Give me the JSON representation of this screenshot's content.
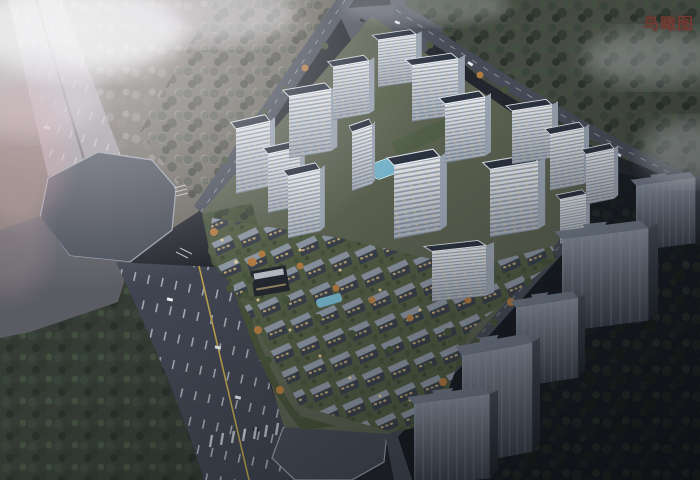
{
  "overlay": {
    "label": "鸟瞰图"
  },
  "scene": {
    "type": "architectural aerial rendering, dusk",
    "features": [
      "white high-rise residential towers along north and east edges (16 visible)",
      "central low-rise courtyard villa district with lit paths and small pools",
      "two octagonal road intersections (west, south)",
      "wide multi-lane boulevard with yellow centerline on the south-west",
      "five dark unlit massing tower blocks on dark ground to the south-east",
      "forest and fog in the top-left, dense dark woods top-right and bottom-left",
      "rooftop-view parking junction at the north corner"
    ]
  },
  "palette": {
    "label": "#743b33",
    "landFog": "#6d6a62",
    "landNE": "#454b42",
    "landDark": "#191e24",
    "forestDark": "#323b33",
    "roadDark": "#3f4450",
    "roadFog": "#9b969b",
    "plaza": "#5b5c63",
    "octagon": "#474c57",
    "siteGround": "#5a6150",
    "lawn": "#515c44",
    "greenBelt": "#475239",
    "towerFace": "#dde3ea",
    "towerRoof": "#2b3340",
    "villaRoof": "#8b95a2",
    "pool": "#74b2c9",
    "evergreen": "#46543c",
    "autumn": "#b07b42",
    "massFace": "#8f98a6",
    "lane": "#cfd6de",
    "yellowLine": "#b9a14e",
    "warmLight": "#dfc187"
  }
}
